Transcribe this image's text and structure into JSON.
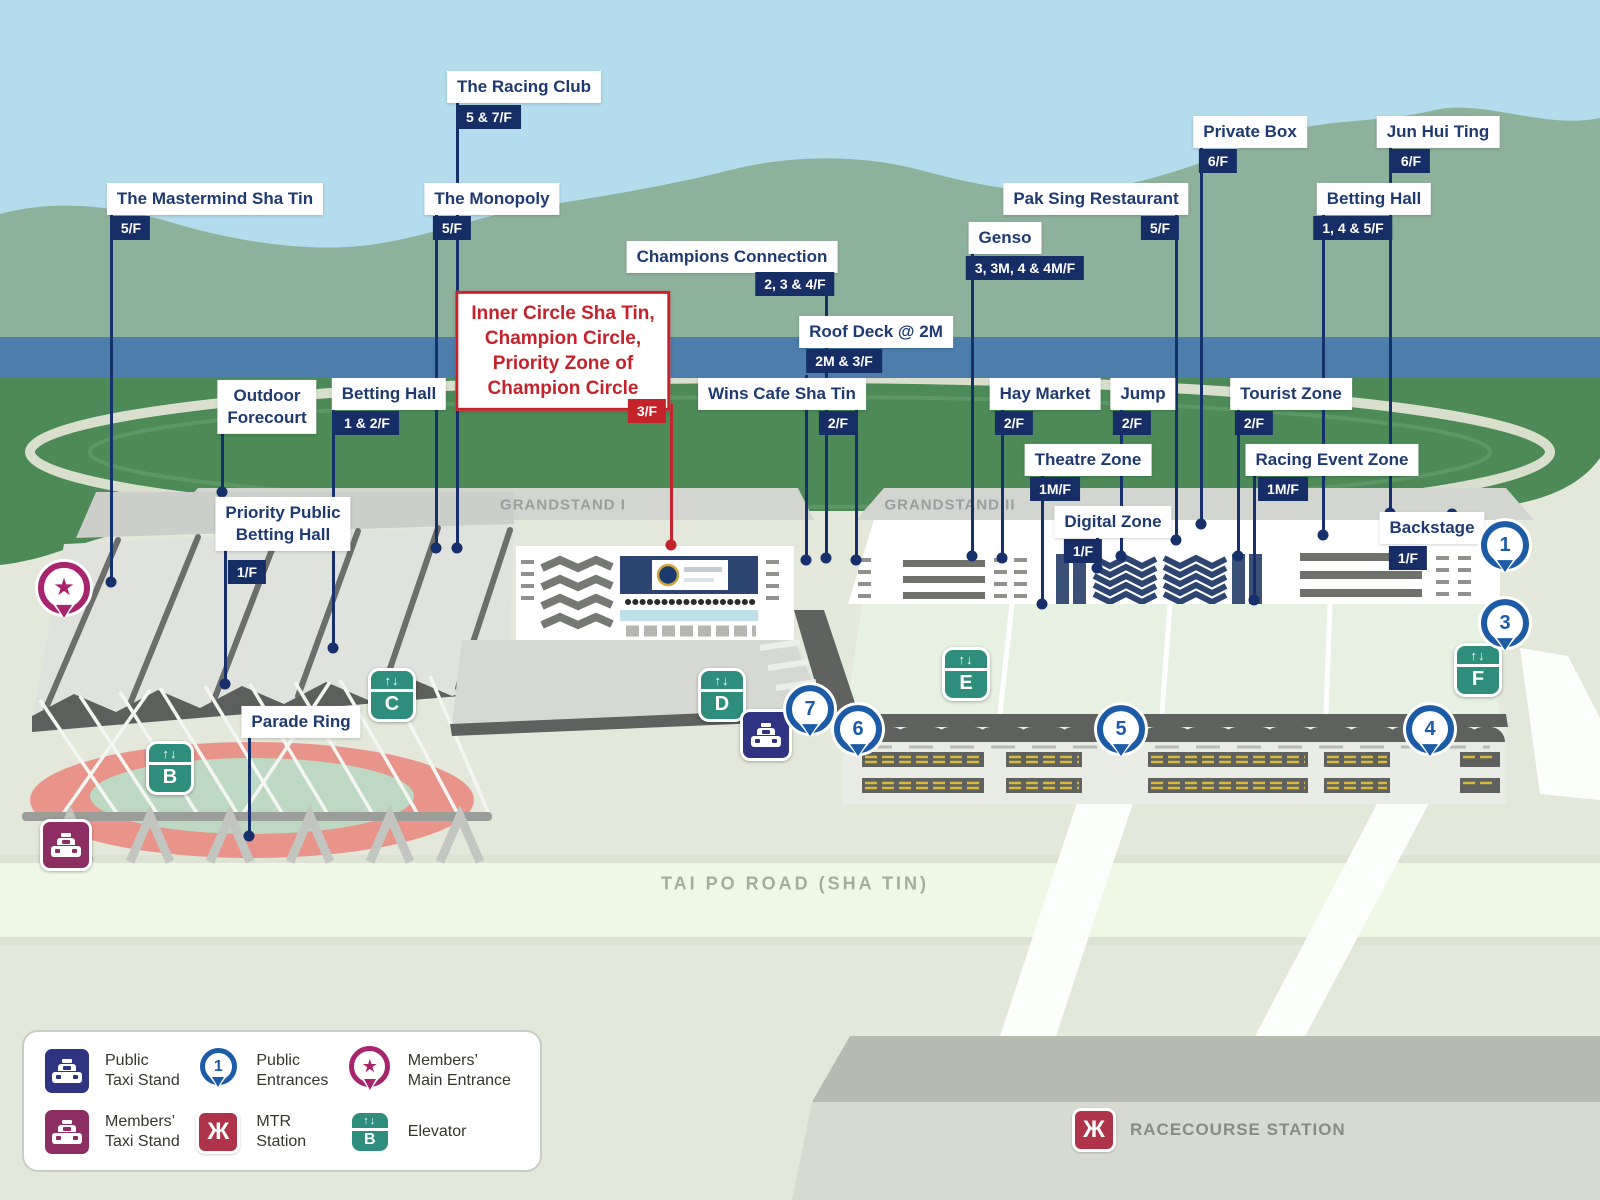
{
  "callouts": [
    {
      "id": "the-racing-club",
      "label": "The Racing Club",
      "floor": "5 & 7/F",
      "style": "navy",
      "label_x": 524,
      "label_y": 87,
      "tag_x": 489,
      "tag_y": 117,
      "line_x": 457,
      "line_y1": 100,
      "dot_y": 548
    },
    {
      "id": "the-mastermind-sha-tin",
      "label": "The Mastermind Sha Tin",
      "floor": "5/F",
      "style": "navy",
      "label_x": 215,
      "label_y": 199,
      "tag_x": 131,
      "tag_y": 228,
      "line_x": 111,
      "line_y1": 212,
      "dot_y": 582
    },
    {
      "id": "the-monopoly",
      "label": "The Monopoly",
      "floor": "5/F",
      "style": "navy",
      "label_x": 492,
      "label_y": 199,
      "tag_x": 452,
      "tag_y": 228,
      "line_x": 436,
      "line_y1": 212,
      "dot_y": 548
    },
    {
      "id": "champions-connection",
      "label": "Champions Connection",
      "floor": "2, 3 & 4/F",
      "style": "navy",
      "label_x": 732,
      "label_y": 257,
      "tag_x": 795,
      "tag_y": 284,
      "line_x": 826,
      "line_y1": 270,
      "dot_y": 558
    },
    {
      "id": "inner-circle-sha-tin",
      "label": "Inner Circle Sha Tin,\nChampion Circle,\nPriority Zone of\nChampion Circle",
      "floor": "3/F",
      "style": "red",
      "label_x": 563,
      "label_y": 351,
      "tag_x": 647,
      "tag_y": 411,
      "line_x": 671,
      "line_y1": 404,
      "dot_y": 545
    },
    {
      "id": "roof-deck-2m",
      "label": "Roof Deck @ 2M",
      "floor": "2M & 3/F",
      "style": "navy",
      "label_x": 876,
      "label_y": 332,
      "tag_x": 844,
      "tag_y": 361,
      "line_x": 806,
      "line_y1": 375,
      "dot_y": 560
    },
    {
      "id": "wins-cafe-sha-tin",
      "label": "Wins Cafe Sha Tin",
      "floor": "2/F",
      "style": "navy",
      "label_x": 782,
      "label_y": 394,
      "tag_x": 838,
      "tag_y": 423,
      "line_x": 856,
      "line_y1": 408,
      "dot_y": 560
    },
    {
      "id": "outdoor-forecourt",
      "label": "Outdoor\nForecourt",
      "style": "navy",
      "label_x": 267,
      "label_y": 407,
      "line_x": 222,
      "line_y1": 434,
      "dot_y": 492
    },
    {
      "id": "betting-hall-grandstand-1",
      "label": "Betting Hall",
      "floor": "1 & 2/F",
      "style": "navy",
      "label_x": 389,
      "label_y": 394,
      "tag_x": 367,
      "tag_y": 423,
      "line_x": 333,
      "line_y1": 408,
      "dot_y": 648
    },
    {
      "id": "priority-public-betting-hall",
      "label": "Priority Public\nBetting Hall",
      "floor": "1/F",
      "style": "navy",
      "label_x": 283,
      "label_y": 524,
      "tag_x": 247,
      "tag_y": 572,
      "line_x": 225,
      "line_y1": 548,
      "dot_y": 684
    },
    {
      "id": "parade-ring",
      "label": "Parade Ring",
      "style": "navy",
      "label_x": 301,
      "label_y": 722,
      "line_x": 249,
      "line_y1": 736,
      "dot_y": 836
    },
    {
      "id": "genso",
      "label": "Genso",
      "floor": "3, 3M, 4 & 4M/F",
      "style": "navy",
      "label_x": 1005,
      "label_y": 238,
      "tag_x": 1025,
      "tag_y": 268,
      "line_x": 972,
      "line_y1": 252,
      "dot_y": 556
    },
    {
      "id": "pak-sing-restaurant",
      "label": "Pak Sing Restaurant",
      "floor": "5/F",
      "style": "navy",
      "label_x": 1096,
      "label_y": 199,
      "tag_x": 1160,
      "tag_y": 228,
      "line_x": 1176,
      "line_y1": 213,
      "dot_y": 540
    },
    {
      "id": "private-box",
      "label": "Private Box",
      "floor": "6/F",
      "style": "navy",
      "label_x": 1250,
      "label_y": 132,
      "tag_x": 1218,
      "tag_y": 161,
      "line_x": 1201,
      "line_y1": 146,
      "dot_y": 524
    },
    {
      "id": "jun-hui-ting",
      "label": "Jun Hui Ting",
      "floor": "6/F",
      "style": "navy",
      "label_x": 1438,
      "label_y": 132,
      "tag_x": 1411,
      "tag_y": 161,
      "line_x": 1390,
      "line_y1": 146,
      "dot_y": 513
    },
    {
      "id": "betting-hall-grandstand-2",
      "label": "Betting Hall",
      "floor": "1, 4 & 5/F",
      "style": "navy",
      "label_x": 1374,
      "label_y": 199,
      "tag_x": 1353,
      "tag_y": 228,
      "line_x": 1323,
      "line_y1": 213,
      "dot_y": 535
    },
    {
      "id": "hay-market",
      "label": "Hay Market",
      "floor": "2/F",
      "style": "navy",
      "label_x": 1045,
      "label_y": 394,
      "tag_x": 1014,
      "tag_y": 423,
      "line_x": 1002,
      "line_y1": 408,
      "dot_y": 558
    },
    {
      "id": "jump",
      "label": "Jump",
      "floor": "2/F",
      "style": "navy",
      "label_x": 1143,
      "label_y": 394,
      "tag_x": 1132,
      "tag_y": 423,
      "line_x": 1121,
      "line_y1": 408,
      "dot_y": 556
    },
    {
      "id": "tourist-zone",
      "label": "Tourist Zone",
      "floor": "2/F",
      "style": "navy",
      "label_x": 1291,
      "label_y": 394,
      "tag_x": 1254,
      "tag_y": 423,
      "line_x": 1238,
      "line_y1": 408,
      "dot_y": 556
    },
    {
      "id": "theatre-zone",
      "label": "Theatre Zone",
      "floor": "1M/F",
      "style": "navy",
      "label_x": 1088,
      "label_y": 460,
      "tag_x": 1055,
      "tag_y": 489,
      "line_x": 1042,
      "line_y1": 474,
      "dot_y": 604
    },
    {
      "id": "racing-event-zone",
      "label": "Racing Event Zone",
      "floor": "1M/F",
      "style": "navy",
      "label_x": 1332,
      "label_y": 460,
      "tag_x": 1283,
      "tag_y": 489,
      "line_x": 1254,
      "line_y1": 474,
      "dot_y": 600
    },
    {
      "id": "digital-zone",
      "label": "Digital Zone",
      "floor": "1/F",
      "style": "navy",
      "label_x": 1113,
      "label_y": 522,
      "tag_x": 1083,
      "tag_y": 551,
      "line_x": 1097,
      "line_y1": 537,
      "dot_y": 568
    },
    {
      "id": "backstage",
      "label": "Backstage",
      "floor": "1/F",
      "style": "navy",
      "label_x": 1432,
      "label_y": 528,
      "tag_x": 1408,
      "tag_y": 558,
      "line_x": 1452,
      "line_y1": 528,
      "dot_y": 514
    }
  ],
  "region_labels": [
    {
      "text": "GRANDSTAND I",
      "x": 563,
      "y": 505
    },
    {
      "text": "GRANDSTAND II",
      "x": 950,
      "y": 505
    }
  ],
  "road_label": {
    "text": "TAI PO ROAD (SHA TIN)"
  },
  "station": {
    "label": "RACECOURSE STATION"
  },
  "entrances": [
    {
      "number": "1",
      "x": 1505,
      "y": 549
    },
    {
      "number": "3",
      "x": 1505,
      "y": 627
    },
    {
      "number": "4",
      "x": 1430,
      "y": 733
    },
    {
      "number": "5",
      "x": 1121,
      "y": 733
    },
    {
      "number": "6",
      "x": 858,
      "y": 733
    },
    {
      "number": "7",
      "x": 810,
      "y": 713
    }
  ],
  "elevators": [
    {
      "letter": "B",
      "x": 170,
      "y": 768
    },
    {
      "letter": "C",
      "x": 392,
      "y": 695
    },
    {
      "letter": "D",
      "x": 722,
      "y": 695
    },
    {
      "letter": "E",
      "x": 966,
      "y": 674
    },
    {
      "letter": "F",
      "x": 1478,
      "y": 670
    }
  ],
  "markers": [
    {
      "type": "members-main-entrance",
      "x": 64,
      "y": 592
    },
    {
      "type": "public-taxi-stand",
      "x": 766,
      "y": 735
    },
    {
      "type": "members-taxi-stand",
      "x": 66,
      "y": 845
    }
  ],
  "legend": {
    "items": [
      {
        "icon": "public-taxi",
        "label": "Public\nTaxi Stand"
      },
      {
        "icon": "public-entrance",
        "badge": "1",
        "label": "Public\nEntrances"
      },
      {
        "icon": "members-entrance",
        "label": "Members’\nMain Entrance"
      },
      {
        "icon": "members-taxi",
        "label": "Members’\nTaxi Stand"
      },
      {
        "icon": "mtr",
        "label": "MTR Station"
      },
      {
        "icon": "elevator",
        "badge": "B",
        "label": "Elevator"
      }
    ]
  },
  "colors": {
    "navy_text": "#1e3a70",
    "navy_tag": "#162d66",
    "leader": "#16306b",
    "red": "#c5232b",
    "pin_blue": "#1d5ba6",
    "elevator_teal": "#2e8d7b",
    "members_magenta": "#a8246f",
    "members_purple": "#8c2d63",
    "public_taxi_navy": "#2e3482",
    "mtr_red": "#b03449",
    "sky": "#b5dcec",
    "mountain": "#8eb19b",
    "river": "#4c7dab",
    "course_green": "#4d8a57",
    "ground": "#e3e8da"
  }
}
